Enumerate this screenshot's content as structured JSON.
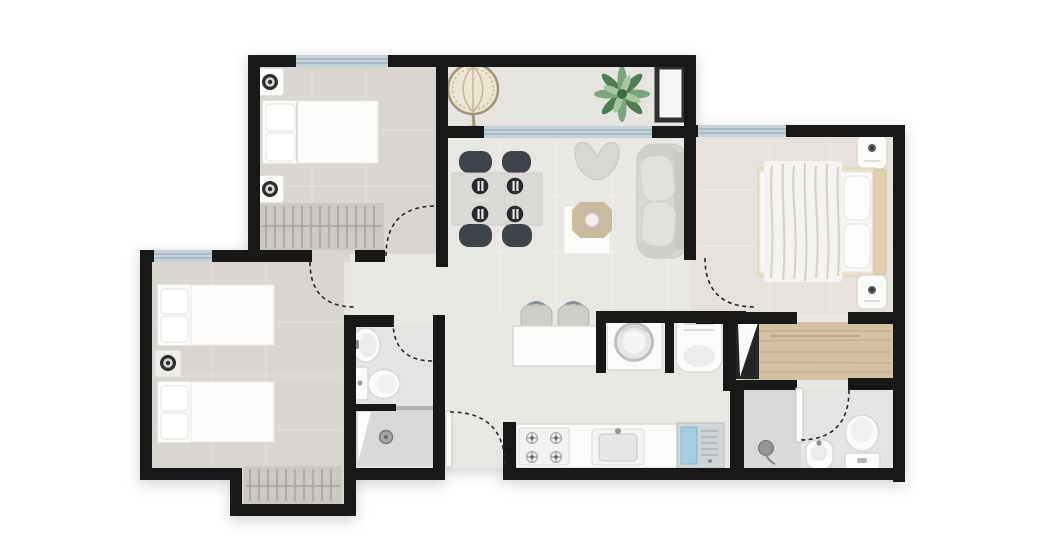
{
  "canvas": {
    "width": 1048,
    "height": 560,
    "background": "#ffffff"
  },
  "colors": {
    "wall": "#181818",
    "floor_main": "#e9e7e4",
    "floor_bedroom": "#d9d5d1",
    "floor_master": "#e6e1dc",
    "floor_balcony": "#e6e4e1",
    "floor_bath": "#e4e4e3",
    "floor_shower": "#d9d9d8",
    "floor_wood": "#d2c2a3",
    "wood_grain": "#b9a584",
    "floor_hall": "#e8e6e3",
    "closet_bg": "#ccc8c4",
    "closet_line": "#b0aca8",
    "window_glass": "#c6d2d9",
    "window_frame": "#8fa4af",
    "white_furniture": "#fbfbfa",
    "furniture_outline": "#d8d7d5",
    "sofa_gray": "#d9d7d4",
    "seat_dark": "#3f434a",
    "plate_dark": "#282a2d",
    "tan": "#e2d0af",
    "tray_tan": "#c8bb9f",
    "metal": "#8a9197",
    "green_dark": "#4f7c55",
    "green_mid": "#7ba57e",
    "green_light": "#a6c6a4",
    "laundry_blue": "#a5cde0",
    "arc_dash": "#2a2a2a",
    "glass_panel": "#b3b3b1",
    "knob_dark": "#2e2e2e",
    "rattan": "#a3947c"
  },
  "apartment": {
    "rooms": [
      {
        "name": "bedroom-top-left",
        "fixtures": [
          "double-bed",
          "nightstand",
          "nightstand",
          "wardrobe"
        ],
        "windows": 1,
        "doors": 1
      },
      {
        "name": "bedroom-left",
        "fixtures": [
          "twin-bed",
          "twin-bed",
          "nightstand",
          "wardrobe"
        ],
        "windows": 1,
        "doors": 1
      },
      {
        "name": "master-bedroom",
        "fixtures": [
          "double-bed",
          "headboard",
          "nightstand",
          "nightstand",
          "closet-hall",
          "wardrobe-mirror"
        ],
        "windows": 1,
        "doors": 2
      },
      {
        "name": "living-dining",
        "fixtures": [
          "dining-table",
          "dining-chair",
          "dining-chair",
          "dining-chair",
          "dining-chair",
          "place-setting",
          "place-setting",
          "place-setting",
          "place-setting",
          "lounge-chair",
          "sofa",
          "coffee-table"
        ]
      },
      {
        "name": "balcony",
        "fixtures": [
          "hanging-chair",
          "plant",
          "bench"
        ],
        "windows": 1
      },
      {
        "name": "kitchen",
        "fixtures": [
          "breakfast-bar",
          "bar-stool",
          "bar-stool",
          "cooktop",
          "kitchen-sink",
          "utility-washboard-sink"
        ],
        "doors": 1
      },
      {
        "name": "laundry-nook",
        "fixtures": [
          "washing-machine",
          "water-heater"
        ]
      },
      {
        "name": "bathroom-center",
        "fixtures": [
          "washbasin",
          "toilet",
          "shower"
        ],
        "doors": 1
      },
      {
        "name": "bathroom-right",
        "fixtures": [
          "shower",
          "washbasin",
          "toilet"
        ],
        "doors": 1
      }
    ]
  }
}
